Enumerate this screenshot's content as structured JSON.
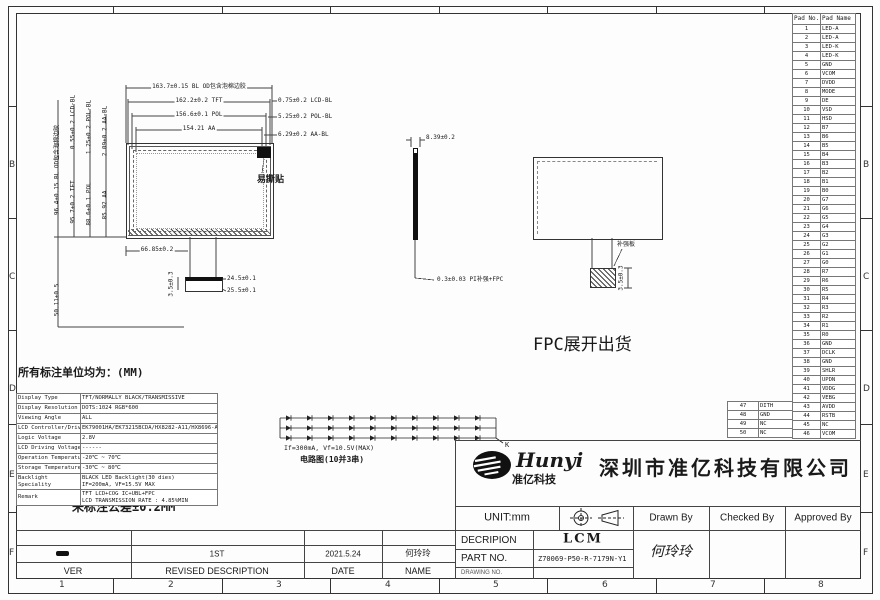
{
  "sheet": {
    "zone_letters": [
      "B",
      "C",
      "D",
      "E",
      "F"
    ],
    "zone_numbers": [
      "1",
      "2",
      "3",
      "4",
      "5",
      "6",
      "7",
      "8"
    ]
  },
  "pad_table": {
    "headers": [
      "Pad No.",
      "Pad Name"
    ],
    "rows": [
      [
        "1",
        "LED-A"
      ],
      [
        "2",
        "LED-A"
      ],
      [
        "3",
        "LED-K"
      ],
      [
        "4",
        "LED-K"
      ],
      [
        "5",
        "GND"
      ],
      [
        "6",
        "VCOM"
      ],
      [
        "7",
        "DVDD"
      ],
      [
        "8",
        "MODE"
      ],
      [
        "9",
        "DE"
      ],
      [
        "10",
        "VSD"
      ],
      [
        "11",
        "HSD"
      ],
      [
        "12",
        "B7"
      ],
      [
        "13",
        "B6"
      ],
      [
        "14",
        "B5"
      ],
      [
        "15",
        "B4"
      ],
      [
        "16",
        "B3"
      ],
      [
        "17",
        "B2"
      ],
      [
        "18",
        "B1"
      ],
      [
        "19",
        "B0"
      ],
      [
        "20",
        "G7"
      ],
      [
        "21",
        "G6"
      ],
      [
        "22",
        "G5"
      ],
      [
        "23",
        "G4"
      ],
      [
        "24",
        "G3"
      ],
      [
        "25",
        "G2"
      ],
      [
        "26",
        "G1"
      ],
      [
        "27",
        "G0"
      ],
      [
        "28",
        "R7"
      ],
      [
        "29",
        "R6"
      ],
      [
        "30",
        "R5"
      ],
      [
        "31",
        "R4"
      ],
      [
        "32",
        "R3"
      ],
      [
        "33",
        "R2"
      ],
      [
        "34",
        "R1"
      ],
      [
        "35",
        "R0"
      ],
      [
        "36",
        "GND"
      ],
      [
        "37",
        "DCLK"
      ],
      [
        "38",
        "GND"
      ],
      [
        "39",
        "SHLR"
      ],
      [
        "40",
        "UPDN"
      ],
      [
        "41",
        "VDDG"
      ],
      [
        "42",
        "VEBG"
      ],
      [
        "43",
        "AVDD"
      ],
      [
        "44",
        "RSTB"
      ],
      [
        "45",
        "NC"
      ],
      [
        "46",
        "VCOM"
      ]
    ],
    "side_rows": [
      [
        "47",
        "DITH"
      ],
      [
        "48",
        "GND"
      ],
      [
        "49",
        "NC"
      ],
      [
        "50",
        "NC"
      ]
    ]
  },
  "spec_table": {
    "rows": [
      [
        "Display Type",
        "TFT/NORMALLY BLACK/TRANSMISSIVE"
      ],
      [
        "Display Resolution",
        "DOTS:1024 RGB*600"
      ],
      [
        "Viewing Angle",
        "ALL"
      ],
      [
        "LCD Controller/Driver",
        "EK79001HA/EK73215BCDA/HX8282-A11/HX8696-A01"
      ],
      [
        "Logic Voltage",
        "2.8V"
      ],
      [
        "LCD Driving Voltage",
        "------"
      ],
      [
        "Operation Temperature",
        "-20℃ ~ 70℃"
      ],
      [
        "Storage Temperature",
        "-30℃ ~ 80℃"
      ],
      [
        "Backlight Speciality",
        "BLACK LED Backlight(30 dies)\nIF=200mA, VF=15.5V MAX"
      ],
      [
        "Remark",
        "TFT LCD+COG IC+UBL+FPC\nLCD TRANSMISSION RATE : 4.85%MIN"
      ]
    ],
    "tolerance_note": "未标注公差±0.2MM"
  },
  "led_circuit": {
    "rows": 3,
    "cols": 10,
    "cathode_label": "K",
    "spec_note": "If=300mA, Vf=10.5V(MAX)",
    "circuit_note": "电路图(10并3串)"
  },
  "drawing": {
    "labels": [
      {
        "n": "dim-bl-od-width",
        "t": "163.7±0.15 BL OD包含泡棉边胶",
        "x": 199,
        "y": 84,
        "fs": 6,
        "c": 1,
        "bg": 1
      },
      {
        "n": "dim-tft-width",
        "t": "162.2±0.2 TFT",
        "x": 199,
        "y": 98,
        "fs": 6,
        "c": 1,
        "bg": 1
      },
      {
        "n": "dim-pol-width",
        "t": "156.6±0.1 POL",
        "x": 199,
        "y": 112,
        "fs": 6,
        "c": 1,
        "bg": 1
      },
      {
        "n": "dim-aa-width",
        "t": "154.21 AA",
        "x": 199,
        "y": 126,
        "fs": 6,
        "c": 1,
        "bg": 1
      },
      {
        "n": "dim-lcd-bl-right",
        "t": "0.75±0.2 LCD-BL",
        "x": 278,
        "y": 98,
        "fs": 6
      },
      {
        "n": "dim-pol-bl-right",
        "t": "5.25±0.2 POL-BL",
        "x": 278,
        "y": 114,
        "fs": 6
      },
      {
        "n": "dim-aa-bl-right",
        "t": "6.29±0.2 AA-BL",
        "x": 278,
        "y": 132,
        "fs": 6
      },
      {
        "n": "dim-bl-od-height",
        "t": "96.4±0.15 BL OD包含泡棉边胶",
        "x": 58,
        "y": 170,
        "fs": 6,
        "r": -90
      },
      {
        "n": "dim-lcd-bl-top",
        "t": "0.55±0.2 LCD-BL",
        "x": 74,
        "y": 122,
        "fs": 6,
        "r": -90
      },
      {
        "n": "dim-tft-height",
        "t": "95.7±0.2 TFT",
        "x": 74,
        "y": 202,
        "fs": 6,
        "r": -90
      },
      {
        "n": "dim-pol-bl-top",
        "t": "1.25±0.2 POL-BL",
        "x": 90,
        "y": 127,
        "fs": 6,
        "r": -90
      },
      {
        "n": "dim-pol-height",
        "t": "88.6±0.1 POL",
        "x": 90,
        "y": 204,
        "fs": 6,
        "r": -90
      },
      {
        "n": "dim-aa-bl-top",
        "t": "2.09±0.2 AA-BL",
        "x": 106,
        "y": 131,
        "fs": 6,
        "r": -90
      },
      {
        "n": "dim-aa-height",
        "t": "85.92 AA",
        "x": 106,
        "y": 205,
        "fs": 6,
        "r": -90
      },
      {
        "n": "dim-fpc-length",
        "t": "50.11±0.5",
        "x": 58,
        "y": 300,
        "fs": 6,
        "r": -90
      },
      {
        "n": "dim-fpc-offset",
        "t": "66.85±0.2",
        "x": 157,
        "y": 247,
        "fs": 6,
        "c": 1,
        "bg": 1
      },
      {
        "n": "dim-connector-width-1",
        "t": "24.5±0.1",
        "x": 227,
        "y": 276,
        "fs": 6
      },
      {
        "n": "dim-connector-width-2",
        "t": "25.5±0.1",
        "x": 227,
        "y": 288,
        "fs": 6
      },
      {
        "n": "dim-connector-height",
        "t": "3.5±0.3",
        "x": 172,
        "y": 284,
        "fs": 6,
        "r": -90
      },
      {
        "n": "easy-tear-label",
        "t": "易撕贴",
        "x": 257,
        "y": 175,
        "fs": 9,
        "b": 1
      },
      {
        "n": "dim-thickness",
        "t": "8.39±0.2",
        "x": 426,
        "y": 135,
        "fs": 6
      },
      {
        "n": "dim-pi-stiffener-fpc",
        "t": "0.3±0.03 PI补强+FPC",
        "x": 437,
        "y": 277,
        "fs": 6
      },
      {
        "n": "fpc-unfold-label",
        "t": "FPC展开出货",
        "x": 533,
        "y": 336,
        "fs": 17
      },
      {
        "n": "stiffener-label",
        "t": "补强板",
        "x": 617,
        "y": 242,
        "fs": 6
      },
      {
        "n": "dim-fpc-tail",
        "t": "3.5±0.3",
        "x": 622,
        "y": 278,
        "fs": 6,
        "r": -90
      },
      {
        "n": "units-note",
        "t": "所有标注单位均为：(MM)",
        "x": 18,
        "y": 367,
        "fs": 11,
        "b": 1
      },
      {
        "n": "led-spec-note",
        "t": "",
        "x": 284,
        "y": 445,
        "fs": 6.5,
        "bindt": "led_circuit.spec_note"
      },
      {
        "n": "led-circuit-note",
        "t": "",
        "x": 300,
        "y": 455,
        "fs": 8,
        "b": 1,
        "bindt": "led_circuit.circuit_note"
      },
      {
        "n": "tolerance-note",
        "t": "",
        "x": 72,
        "y": 501,
        "fs": 12,
        "b": 1,
        "bindt": "spec_table.tolerance_note"
      }
    ]
  },
  "title_block": {
    "brand": "Hunyi",
    "brand_sub": "准亿科技",
    "company": "深圳市准亿科技有限公司",
    "unit_label": "UNIT:mm",
    "drawn_by_label": "Drawn By",
    "checked_by_label": "Checked By",
    "approved_by_label": "Approved By",
    "description_label": "DECRIPION",
    "description_value": "LCM",
    "part_no_label": "PART NO.",
    "part_no_value": "Z70069-P50-R-7179N-Y1",
    "drawing_no_label": "DRAWING NO.",
    "drawn_by_value": "何玲玲"
  },
  "revision": {
    "headers": [
      "VER",
      "REVISED DESCRIPTION",
      "DATE",
      "NAME"
    ],
    "entry": {
      "ver": "",
      "description": "1ST",
      "date": "2021.5.24",
      "name": "何玲玲"
    }
  }
}
